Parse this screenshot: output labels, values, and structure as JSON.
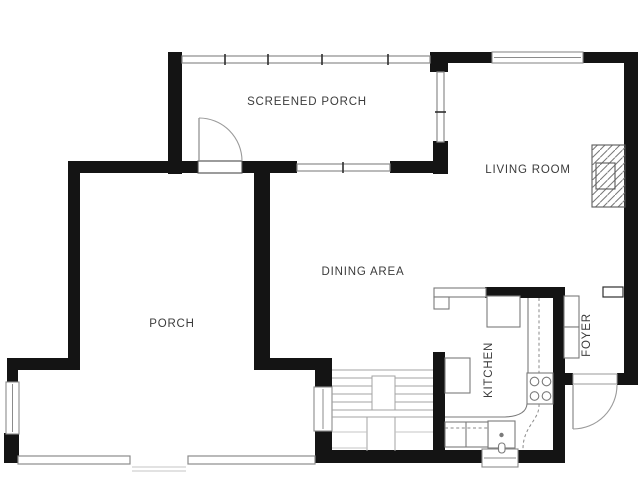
{
  "floor_plan": {
    "colors": {
      "background": "#ffffff",
      "wall": "#141414",
      "line": "#8b8b8b",
      "label": "#3b3b3b",
      "hatch": "#787878"
    },
    "rooms": [
      {
        "label": "SCREENED PORCH"
      },
      {
        "label": "LIVING ROOM"
      },
      {
        "label": "DINING AREA"
      },
      {
        "label": "PORCH"
      },
      {
        "label": "KITCHEN"
      },
      {
        "label": "FOYER"
      }
    ]
  }
}
